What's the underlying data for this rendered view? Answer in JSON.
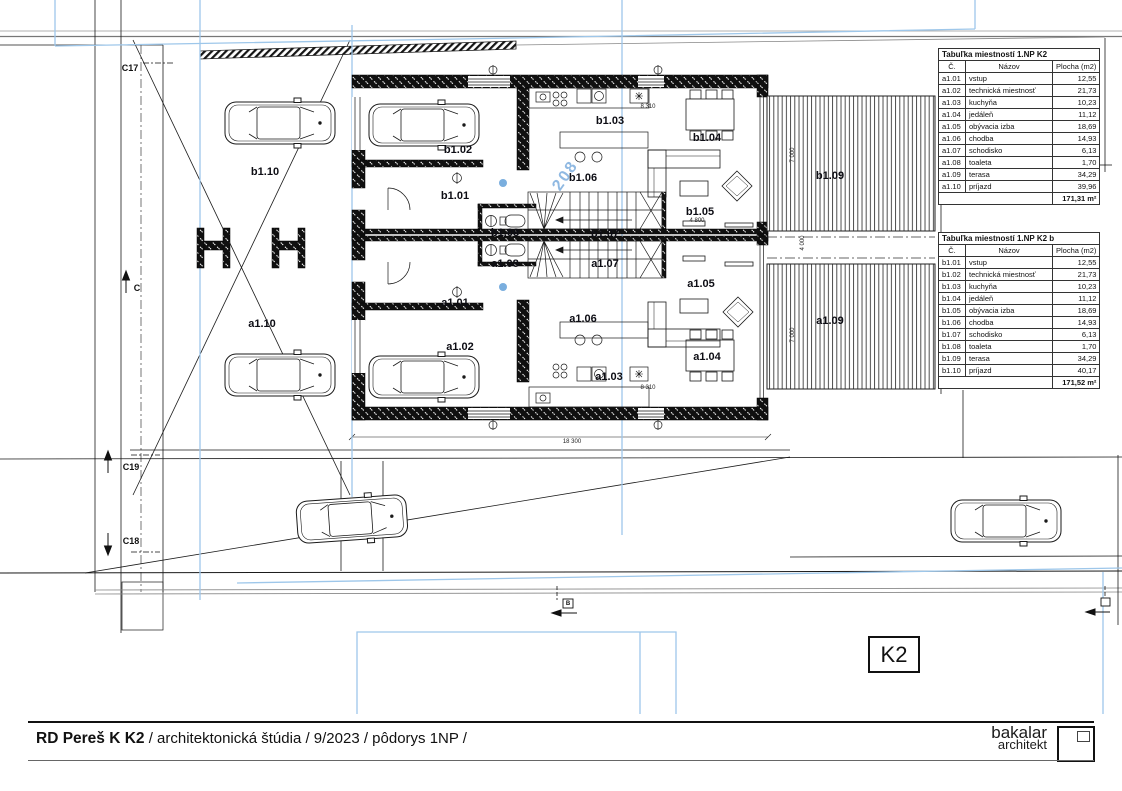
{
  "sheet": {
    "code": "K2",
    "title_bold": "RD Pereš K K2",
    "title_rest": " / architektonická štúdia / 9/2023 / pôdorys 1NP /",
    "logo": {
      "line1": "bakalar",
      "line2": "architekt"
    }
  },
  "tables": [
    {
      "title": "Tabuľka miestností 1.NP K2",
      "headers": [
        "Č.",
        "Názov",
        "Plocha (m2)"
      ],
      "rows": [
        [
          "a1.01",
          "vstup",
          "12,55"
        ],
        [
          "a1.02",
          "technická miestnosť",
          "21,73"
        ],
        [
          "a1.03",
          "kuchyňa",
          "10,23"
        ],
        [
          "a1.04",
          "jedáleň",
          "11,12"
        ],
        [
          "a1.05",
          "obývacia izba",
          "18,69"
        ],
        [
          "a1.06",
          "chodba",
          "14,93"
        ],
        [
          "a1.07",
          "schodisko",
          "6,13"
        ],
        [
          "a1.08",
          "toaleta",
          "1,70"
        ],
        [
          "a1.09",
          "terasa",
          "34,29"
        ],
        [
          "a1.10",
          "príjazd",
          "39,96"
        ]
      ],
      "total": "171,31 m²"
    },
    {
      "title": "Tabuľka miestností 1.NP K2 b",
      "headers": [
        "Č.",
        "Názov",
        "Plocha (m2)"
      ],
      "rows": [
        [
          "b1.01",
          "vstup",
          "12,55"
        ],
        [
          "b1.02",
          "technická miestnosť",
          "21,73"
        ],
        [
          "b1.03",
          "kuchyňa",
          "10,23"
        ],
        [
          "b1.04",
          "jedáleň",
          "11,12"
        ],
        [
          "b1.05",
          "obývacia izba",
          "18,69"
        ],
        [
          "b1.06",
          "chodba",
          "14,93"
        ],
        [
          "b1.07",
          "schodisko",
          "6,13"
        ],
        [
          "b1.08",
          "toaleta",
          "1,70"
        ],
        [
          "b1.09",
          "terasa",
          "34,29"
        ],
        [
          "b1.10",
          "príjazd",
          "40,17"
        ]
      ],
      "total": "171,52 m²"
    }
  ],
  "plan": {
    "rooms": {
      "b01": "b1.01",
      "b02": "b1.02",
      "b03": "b1.03",
      "b04": "b1.04",
      "b05": "b1.05",
      "b06": "b1.06",
      "b07": "b1.07",
      "b08": "b1.08",
      "b09": "b1.09",
      "b10": "b1.10",
      "a01": "a1.01",
      "a02": "a1.02",
      "a03": "a1.03",
      "a04": "a1.04",
      "a05": "a1.05",
      "a06": "a1.06",
      "a07": "a1.07",
      "a08": "a1.08",
      "a09": "a1.09",
      "a10": "a1.10"
    },
    "elevation_note": "208",
    "markers": {
      "c17": "C17",
      "c18": "C18",
      "c19": "C19",
      "c": "C",
      "b": "B"
    },
    "dims": {
      "d18300": "18 300",
      "d8310": "8 310",
      "d4800": "4 800",
      "d6750": "6 750",
      "d7000": "7 000",
      "d4000": "4 000"
    }
  },
  "colors": {
    "line": "#1a1a1a",
    "guide_blue": "#9ec7ea",
    "label": "#0d0d14"
  }
}
